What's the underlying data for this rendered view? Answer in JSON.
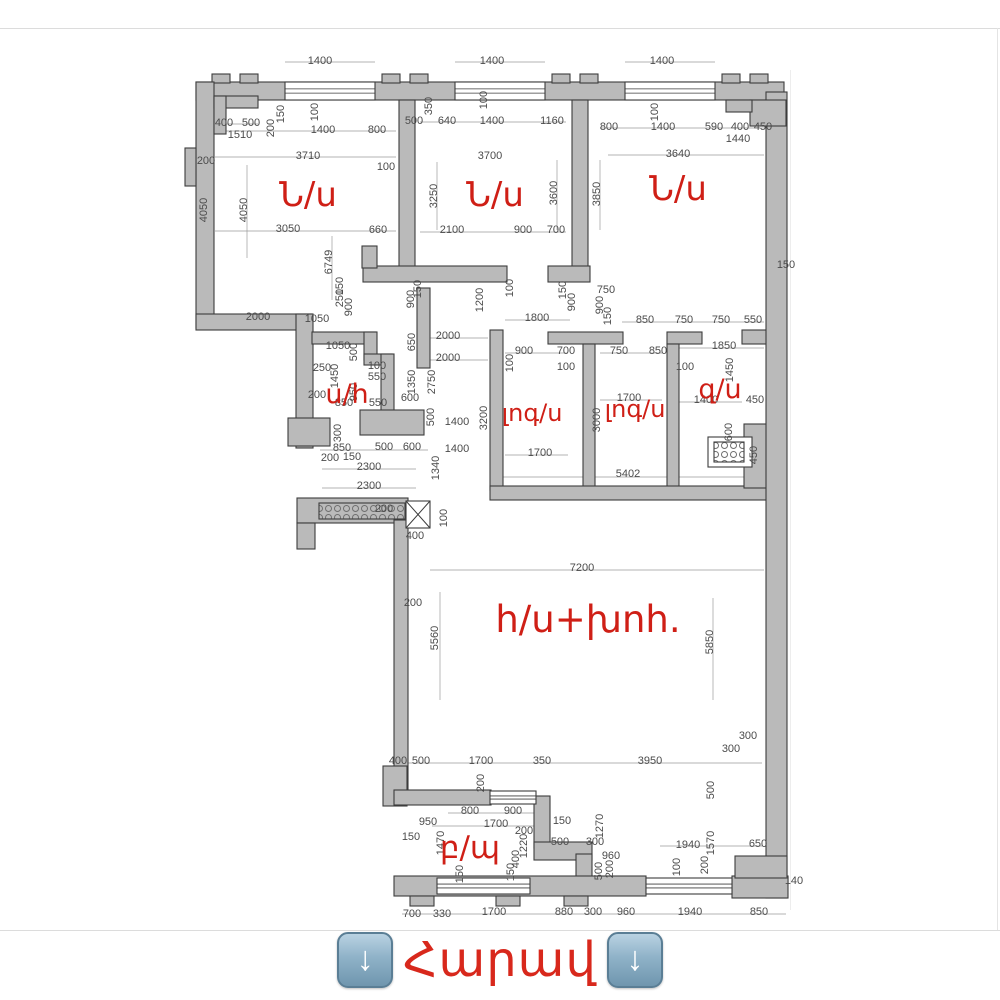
{
  "plan": {
    "title": "apartment-floor-plan",
    "accent_color": "#cf1f16",
    "wall_color": "#bababa",
    "rooms": [
      {
        "label": "Ն/ս",
        "x": 308,
        "y": 206,
        "size": 34
      },
      {
        "label": "Ն/ս",
        "x": 495,
        "y": 206,
        "size": 34
      },
      {
        "label": "Ն/ս",
        "x": 678,
        "y": 200,
        "size": 34
      },
      {
        "label": "ս/հ",
        "x": 347,
        "y": 403,
        "size": 27
      },
      {
        "label": "լոգ/ս",
        "x": 532,
        "y": 421,
        "size": 24
      },
      {
        "label": "լոգ/ս",
        "x": 635,
        "y": 417,
        "size": 24
      },
      {
        "label": "զ/ս",
        "x": 720,
        "y": 398,
        "size": 27
      },
      {
        "label": "հ/ս+խոհ.",
        "x": 588,
        "y": 632,
        "size": 37
      },
      {
        "label": "բ/պ",
        "x": 470,
        "y": 858,
        "size": 31
      }
    ],
    "dimensions": [
      [
        1400,
        320,
        64
      ],
      [
        1400,
        492,
        64
      ],
      [
        1400,
        662,
        64
      ],
      [
        400,
        224,
        126
      ],
      [
        500,
        251,
        126
      ],
      [
        1510,
        240,
        138
      ],
      [
        150,
        284,
        114,
        1
      ],
      [
        200,
        274,
        128,
        1
      ],
      [
        100,
        318,
        112,
        1
      ],
      [
        1400,
        323,
        133
      ],
      [
        800,
        377,
        133
      ],
      [
        3710,
        308,
        159
      ],
      [
        200,
        206,
        164
      ],
      [
        100,
        386,
        170
      ],
      [
        4050,
        207,
        210,
        1
      ],
      [
        4050,
        247,
        210,
        1
      ],
      [
        3050,
        288,
        232
      ],
      [
        660,
        378,
        233
      ],
      [
        6749,
        332,
        262,
        1
      ],
      [
        350,
        432,
        106,
        1
      ],
      [
        500,
        414,
        124
      ],
      [
        640,
        447,
        124
      ],
      [
        1400,
        492,
        124
      ],
      [
        1160,
        552,
        124
      ],
      [
        100,
        487,
        100,
        1
      ],
      [
        3700,
        490,
        159
      ],
      [
        3250,
        437,
        196,
        1
      ],
      [
        3600,
        557,
        193,
        1
      ],
      [
        2100,
        452,
        233
      ],
      [
        900,
        523,
        233
      ],
      [
        700,
        556,
        233
      ],
      [
        100,
        658,
        112,
        1
      ],
      [
        800,
        609,
        130
      ],
      [
        1400,
        663,
        130
      ],
      [
        590,
        714,
        130
      ],
      [
        400,
        740,
        130
      ],
      [
        450,
        763,
        130
      ],
      [
        1440,
        738,
        142
      ],
      [
        3640,
        678,
        157
      ],
      [
        3850,
        600,
        194,
        1
      ],
      [
        150,
        786,
        268
      ],
      [
        2000,
        258,
        320
      ],
      [
        1050,
        317,
        322
      ],
      [
        150,
        343,
        286,
        1
      ],
      [
        250,
        343,
        298,
        1
      ],
      [
        900,
        352,
        307,
        1
      ],
      [
        900,
        414,
        299,
        1
      ],
      [
        150,
        421,
        289,
        1
      ],
      [
        1050,
        338,
        349
      ],
      [
        500,
        357,
        352,
        1
      ],
      [
        650,
        415,
        342,
        1
      ],
      [
        2000,
        448,
        339
      ],
      [
        2000,
        448,
        361
      ],
      [
        250,
        322,
        371
      ],
      [
        1450,
        338,
        376,
        1
      ],
      [
        100,
        377,
        369
      ],
      [
        550,
        377,
        380
      ],
      [
        950,
        357,
        392,
        1
      ],
      [
        200,
        317,
        398
      ],
      [
        850,
        344,
        406
      ],
      [
        550,
        378,
        406
      ],
      [
        600,
        410,
        401
      ],
      [
        1350,
        415,
        382,
        1
      ],
      [
        2750,
        435,
        382,
        1
      ],
      [
        500,
        434,
        417,
        1
      ],
      [
        1400,
        457,
        425
      ],
      [
        1400,
        457,
        452
      ],
      [
        1340,
        439,
        468,
        1
      ],
      [
        300,
        341,
        433,
        1
      ],
      [
        850,
        342,
        451
      ],
      [
        500,
        384,
        450
      ],
      [
        600,
        412,
        450
      ],
      [
        200,
        330,
        461
      ],
      [
        150,
        352,
        460
      ],
      [
        2300,
        369,
        470
      ],
      [
        2300,
        369,
        489
      ],
      [
        200,
        384,
        512
      ],
      [
        100,
        447,
        518,
        1
      ],
      [
        400,
        415,
        539
      ],
      [
        100,
        513,
        288,
        1
      ],
      [
        1200,
        483,
        300,
        1
      ],
      [
        1800,
        537,
        321
      ],
      [
        150,
        566,
        290,
        1
      ],
      [
        900,
        575,
        302,
        1
      ],
      [
        750,
        606,
        293
      ],
      [
        900,
        603,
        305,
        1
      ],
      [
        150,
        611,
        316,
        1
      ],
      [
        850,
        645,
        323
      ],
      [
        750,
        684,
        323
      ],
      [
        750,
        721,
        323
      ],
      [
        550,
        753,
        323
      ],
      [
        100,
        513,
        363,
        1
      ],
      [
        900,
        524,
        354
      ],
      [
        700,
        566,
        354
      ],
      [
        100,
        566,
        370
      ],
      [
        750,
        619,
        354
      ],
      [
        850,
        658,
        354
      ],
      [
        100,
        685,
        370
      ],
      [
        1850,
        724,
        349
      ],
      [
        1450,
        733,
        370,
        1
      ],
      [
        1400,
        706,
        403
      ],
      [
        450,
        755,
        403
      ],
      [
        600,
        732,
        432,
        1
      ],
      [
        450,
        757,
        455,
        1
      ],
      [
        3200,
        487,
        418,
        1
      ],
      [
        3000,
        600,
        420,
        1
      ],
      [
        1700,
        629,
        401
      ],
      [
        1700,
        540,
        456
      ],
      [
        5402,
        628,
        477
      ],
      [
        7200,
        582,
        571
      ],
      [
        200,
        413,
        606
      ],
      [
        5560,
        438,
        638,
        1
      ],
      [
        5850,
        713,
        642,
        1
      ],
      [
        300,
        748,
        739
      ],
      [
        300,
        731,
        752
      ],
      [
        500,
        714,
        790,
        1
      ],
      [
        1570,
        714,
        843,
        1
      ],
      [
        3950,
        650,
        764
      ],
      [
        350,
        542,
        764
      ],
      [
        1700,
        481,
        764
      ],
      [
        500,
        421,
        764
      ],
      [
        400,
        398,
        764
      ],
      [
        1940,
        688,
        848
      ],
      [
        100,
        680,
        867,
        1
      ],
      [
        200,
        708,
        865,
        1
      ],
      [
        650,
        758,
        847
      ],
      [
        140,
        794,
        884
      ],
      [
        200,
        484,
        783,
        1
      ],
      [
        800,
        470,
        814
      ],
      [
        900,
        513,
        814
      ],
      [
        1700,
        496,
        827
      ],
      [
        950,
        428,
        825
      ],
      [
        150,
        411,
        840
      ],
      [
        1470,
        444,
        843,
        1
      ],
      [
        200,
        524,
        834
      ],
      [
        1220,
        527,
        846,
        1
      ],
      [
        400,
        519,
        859,
        1
      ],
      [
        150,
        463,
        874,
        1
      ],
      [
        150,
        514,
        872,
        1
      ],
      [
        150,
        562,
        824
      ],
      [
        500,
        560,
        845
      ],
      [
        300,
        595,
        845
      ],
      [
        1270,
        603,
        826,
        1
      ],
      [
        960,
        611,
        859
      ],
      [
        500,
        602,
        871,
        1
      ],
      [
        200,
        613,
        869,
        1
      ],
      [
        700,
        412,
        917
      ],
      [
        330,
        442,
        917
      ],
      [
        1700,
        494,
        915
      ],
      [
        880,
        564,
        915
      ],
      [
        300,
        593,
        915
      ],
      [
        960,
        626,
        915
      ],
      [
        1940,
        690,
        915
      ],
      [
        850,
        759,
        915
      ]
    ]
  },
  "caption": {
    "arrow_glyph": "↓",
    "text": "Հարավ"
  }
}
